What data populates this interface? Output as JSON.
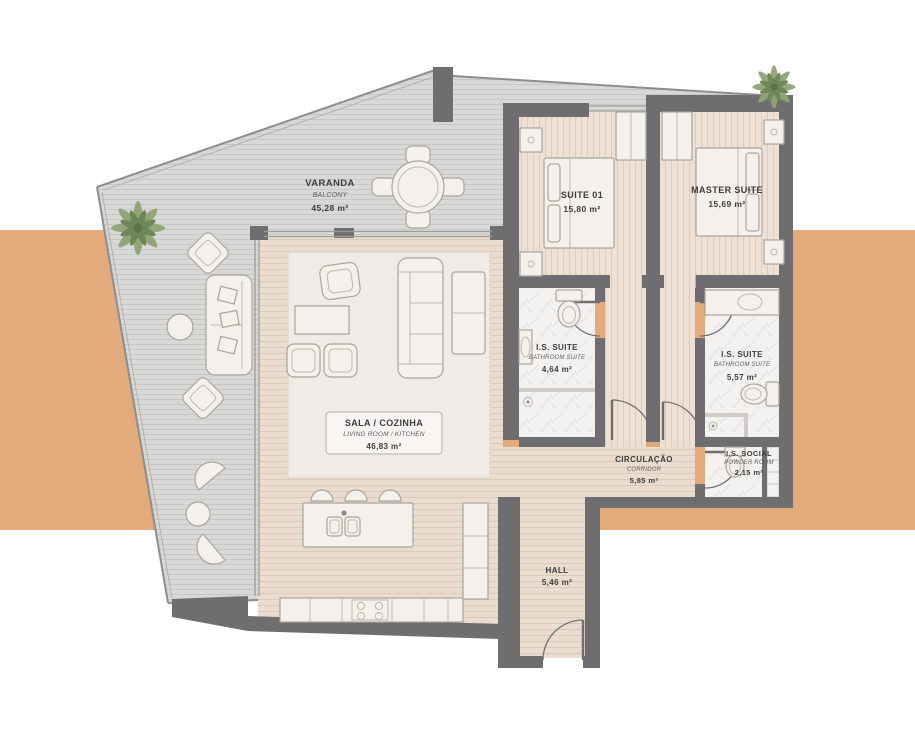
{
  "title": "Apartment floor plan",
  "colors": {
    "accent_band": "#e3aa7c",
    "wall": "#6e6e70",
    "deck": "#d8d8d6",
    "wood_floor": "#eaddcf",
    "bedroom_floor": "#eee0d2",
    "marble_floor": "#f3f2f0",
    "furniture": "#f4f0ec",
    "label_text": "#3c3c3e",
    "palm_green": "#8ea477"
  },
  "rooms": {
    "varanda": {
      "name": "VARANDA",
      "subtitle": "BALCONY",
      "area": "45,28 m²"
    },
    "suite01": {
      "name": "SUITE 01",
      "area": "15,80 m²"
    },
    "master": {
      "name": "MASTER SUITE",
      "area": "15,69 m²"
    },
    "sala": {
      "name": "SALA / COZINHA",
      "subtitle": "LIVING ROOM / KITCHEN",
      "area": "46,83 m²"
    },
    "is_suite_1": {
      "name": "I.S. SUITE",
      "subtitle": "BATHROOM SUITE",
      "area": "4,64 m²"
    },
    "is_suite_2": {
      "name": "I.S. SUITE",
      "subtitle": "BATHROOM SUITE",
      "area": "5,57 m²"
    },
    "is_social": {
      "name": "I.S. SOCIAL",
      "subtitle": "POWDER ROOM",
      "area": "2,15 m²"
    },
    "circulacao": {
      "name": "CIRCULAÇÃO",
      "subtitle": "CORRIDOR",
      "area": "5,85 m²"
    },
    "hall": {
      "name": "HALL",
      "area": "5,46 m²"
    }
  }
}
